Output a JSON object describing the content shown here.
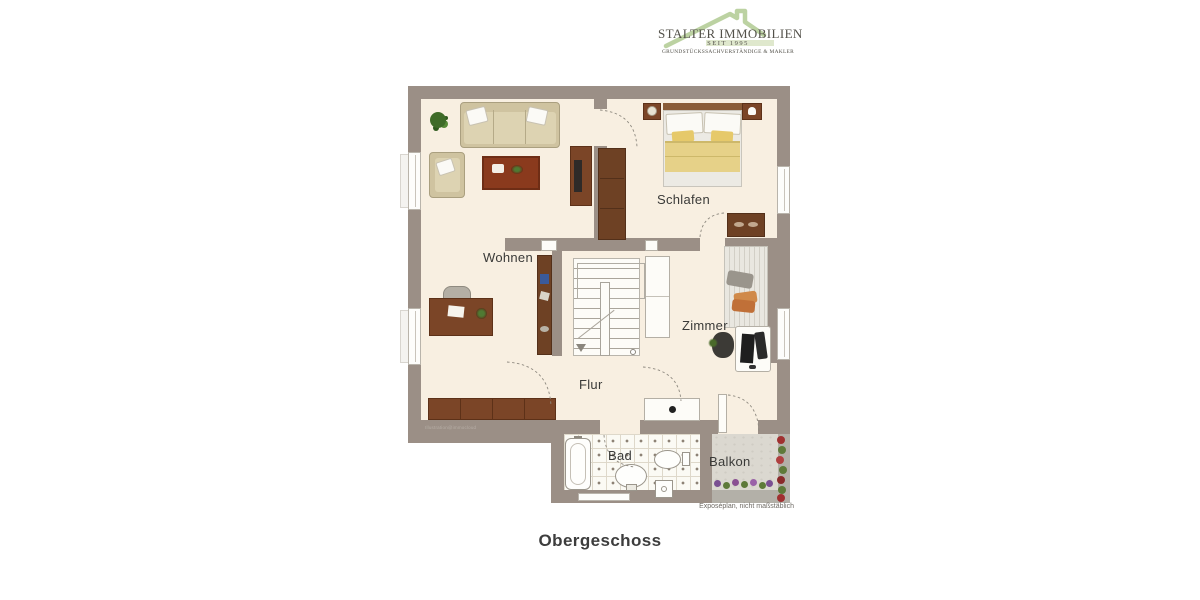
{
  "logo": {
    "line1": "STALTER IMMOBILIEN",
    "line2": "SEIT 1995",
    "line3": "GRUNDSTÜCKSSACHVERSTÄNDIGE & MAKLER",
    "house_color": "#bcd2a2",
    "text_color": "#53514a"
  },
  "rooms": {
    "wohnen": "Wohnen",
    "schlafen": "Schlafen",
    "zimmer": "Zimmer",
    "flur": "Flur",
    "bad": "Bad",
    "balkon": "Balkon"
  },
  "page": {
    "title": "Obergeschoss",
    "caption": "Exposéplan, nicht maßstäblich",
    "watermark": "Illustration@immocloud"
  },
  "colors": {
    "wall": "#9b8f86",
    "floor": "#f8efe1",
    "wood": "#7b4527",
    "tile_floor": "#fbfaf4",
    "balcony_floor": "#dbd8d0",
    "label_text": "#3a3a38"
  }
}
